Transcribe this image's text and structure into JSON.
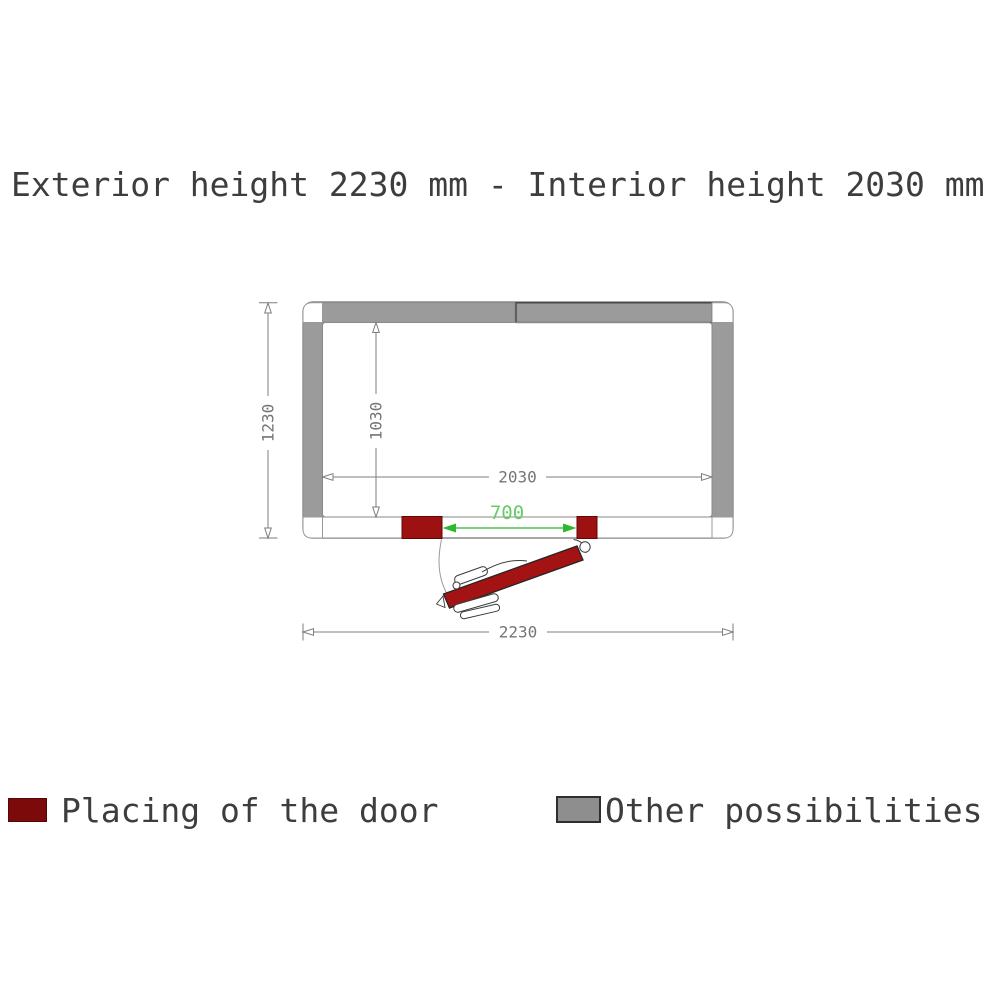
{
  "title": "Exterior height 2230 mm - Interior height 2030 mm",
  "diagram": {
    "dimensions": {
      "exterior_width_mm": "2230",
      "exterior_depth_mm": "1230",
      "interior_width_mm": "2030",
      "interior_depth_mm": "1030",
      "door_opening_mm": "700"
    }
  },
  "legend": {
    "door_label": "Placing of the door",
    "other_label": "Other possibilities"
  },
  "colors": {
    "door_red": "#a31313",
    "jamb_red": "#9e1111",
    "legend_red": "#7c0a0a",
    "wall_gray": "#9b9b9b",
    "legend_gray": "#8e8e8e",
    "dimension_gray": "#7d7d7d",
    "dimension_green": "#2eb82e",
    "dimension_green_text": "#66cc66",
    "text_dark": "#3d3d3d"
  }
}
